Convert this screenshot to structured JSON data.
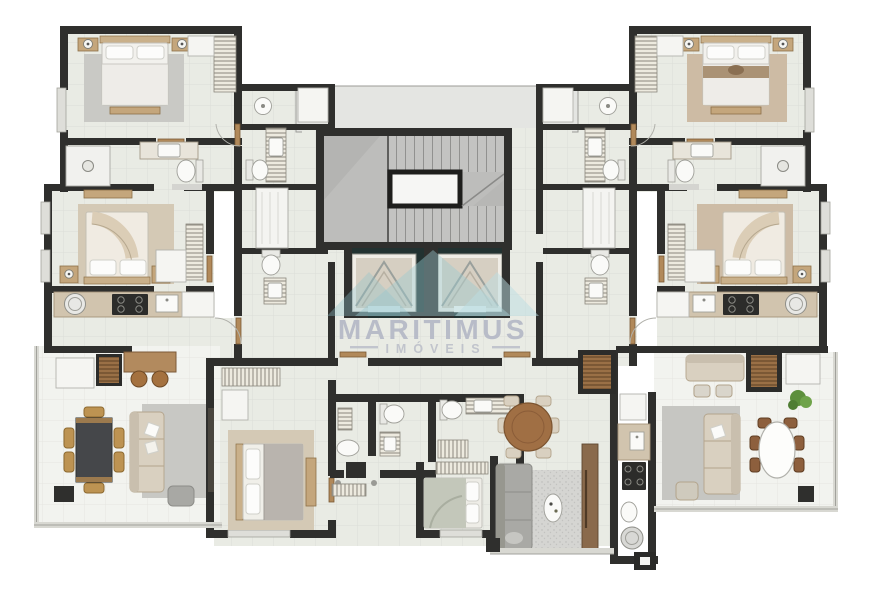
{
  "watermark": {
    "title": "MARITIMUS",
    "subtitle": "IMÓVEIS"
  },
  "palette": {
    "background": "#ffffff",
    "wall": "#2f2f2d",
    "floor_tile": "#e9ebe4",
    "terrace_tile": "#f2f3ef",
    "stair_floor": "#bdbdbb",
    "elevator_shaft": "#223231",
    "rug_gray": "#c9c9c5",
    "rug_beige": "#d4c9b5",
    "rug_tan": "#cdbba4",
    "wood": "#a9805a",
    "logo_teal": "#9ccbd2",
    "watermark_text": "#b2b6c5"
  },
  "plan": {
    "units": [
      {
        "name": "apartment-left",
        "rooms": [
          "master-suite",
          "suite-bathroom",
          "bedroom-2",
          "service-bathrooms",
          "kitchen",
          "living-dining-terrace"
        ]
      },
      {
        "name": "apartment-right",
        "rooms": [
          "master-suite",
          "suite-bathroom",
          "bedroom-2",
          "service-bathrooms",
          "kitchen",
          "living-dining-terrace"
        ]
      },
      {
        "name": "apartment-bottom-center",
        "rooms": [
          "bedroom",
          "twin-bathrooms",
          "suite-bedroom",
          "suite-bathroom",
          "living-dining",
          "galley-kitchen",
          "terrace"
        ]
      }
    ],
    "core": [
      "technical-hall",
      "staircase",
      "elevator-1",
      "elevator-2",
      "elevator-lobby"
    ]
  }
}
